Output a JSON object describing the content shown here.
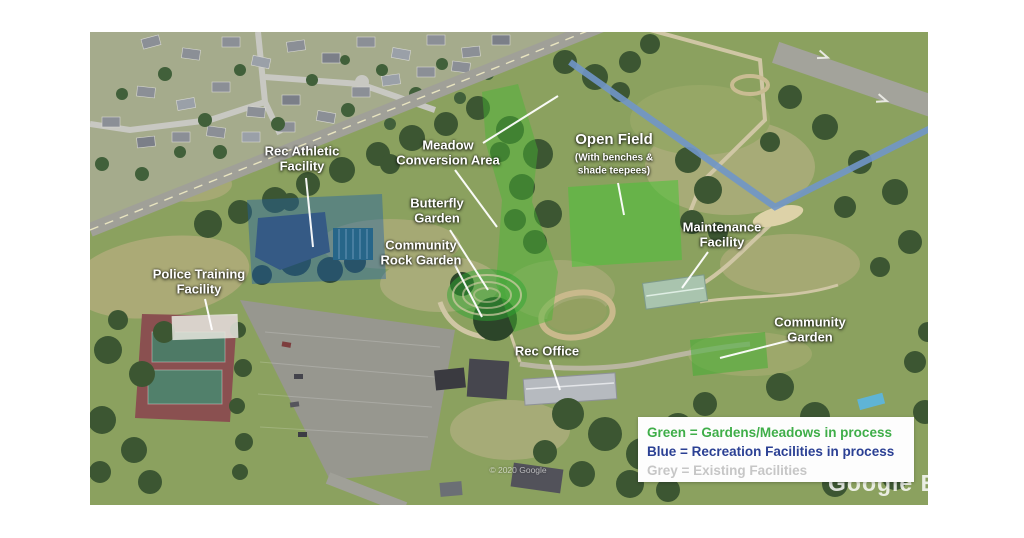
{
  "map": {
    "attribution": "© 2020 Google",
    "watermark": "Google E",
    "labels": {
      "rec_athletic": "Rec Athletic\nFacility",
      "meadow": "Meadow\nConversion Area",
      "open_field_title": "Open Field",
      "open_field_sub": "(With benches &\nshade teepees)",
      "butterfly": "Butterfly\nGarden",
      "rock_garden": "Community\nRock Garden",
      "maintenance": "Maintenance\nFacility",
      "police": "Police Training\nFacility",
      "community_garden": "Community Garden",
      "rec_office": "Rec Office"
    },
    "legend": {
      "items": [
        {
          "text": "Green = Gardens/Meadows in process",
          "color": "#3fae49"
        },
        {
          "text": "Blue = Recreation Facilities in process",
          "color": "#2b4094"
        },
        {
          "text": "Grey = Existing Facilities",
          "color": "#c6c6c6"
        }
      ]
    },
    "colors": {
      "garden_overlay": "#47c32e",
      "recreation_overlay": "#1e5aa0",
      "existing_overlay": "#e1e1da",
      "trail": "#7096c8"
    }
  }
}
